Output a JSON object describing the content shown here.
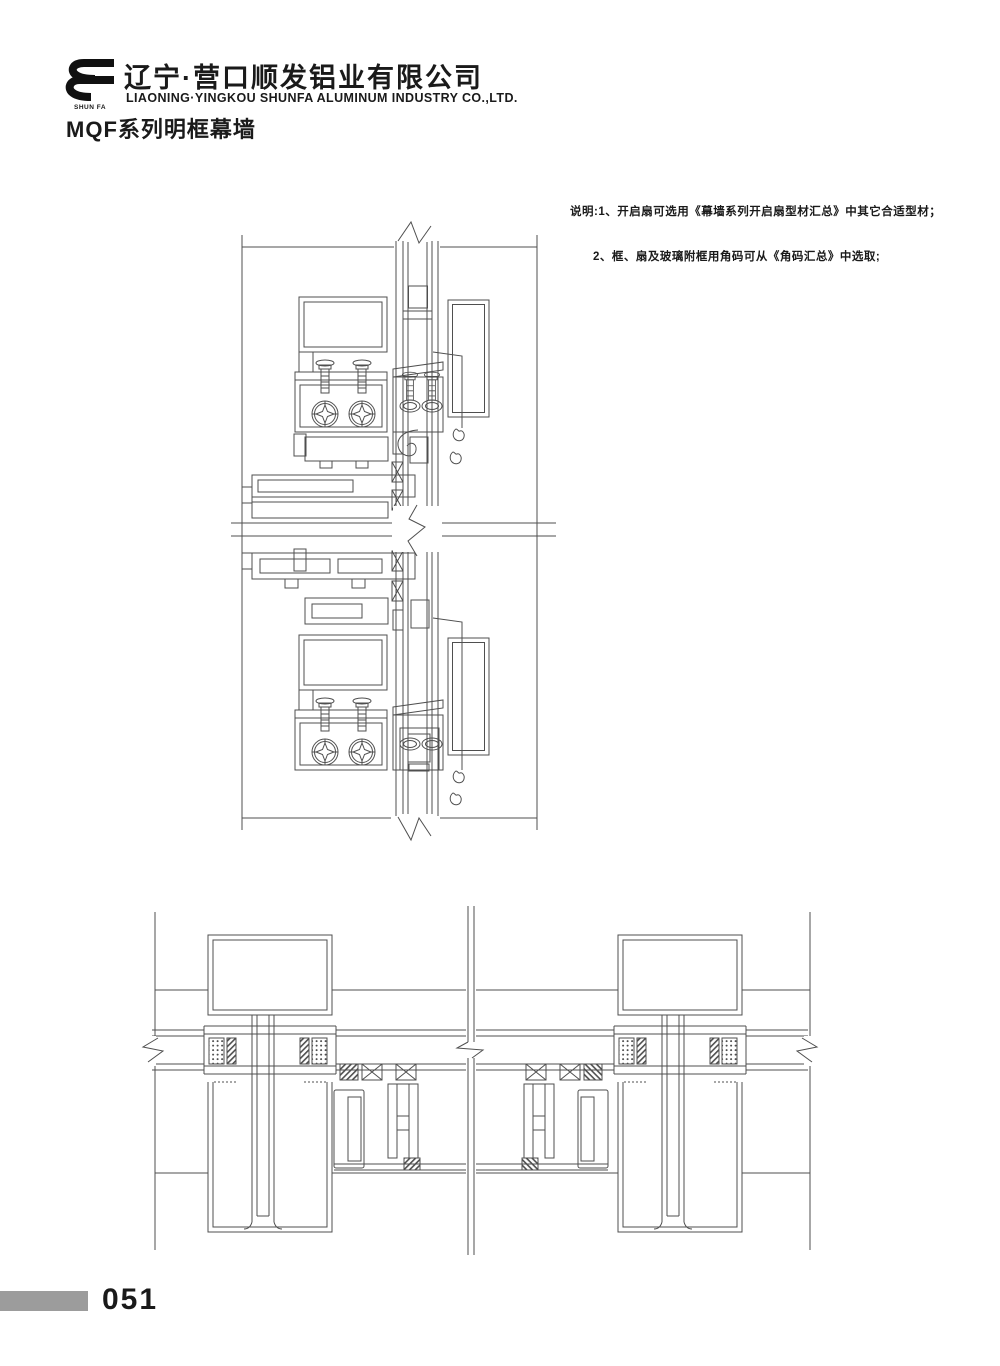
{
  "header": {
    "company_cn": "辽宁·营口顺发铝业有限公司",
    "company_en": "LIAONING·YINGKOU SHUNFA ALUMINUM INDUSTRY CO.,LTD.",
    "logo_caption": "SHUN FA",
    "series_title": "MQF系列明框幕墙"
  },
  "notes": {
    "line1": "说明:1、开启扇可选用《幕墙系列开启扇型材汇总》中其它合适型材；",
    "line2": "2、框、扇及玻璃附框用角码可从《角码汇总》中选取;"
  },
  "figures": {
    "vertical_section_name": "vertical-section-detail",
    "horizontal_section_name": "horizontal-section-detail"
  },
  "footer": {
    "page_number": "051"
  },
  "colors": {
    "drawing_line": "#4f4f4f",
    "footer_bar": "#9c9c9c",
    "text": "#1a1a1a",
    "background": "#ffffff"
  }
}
